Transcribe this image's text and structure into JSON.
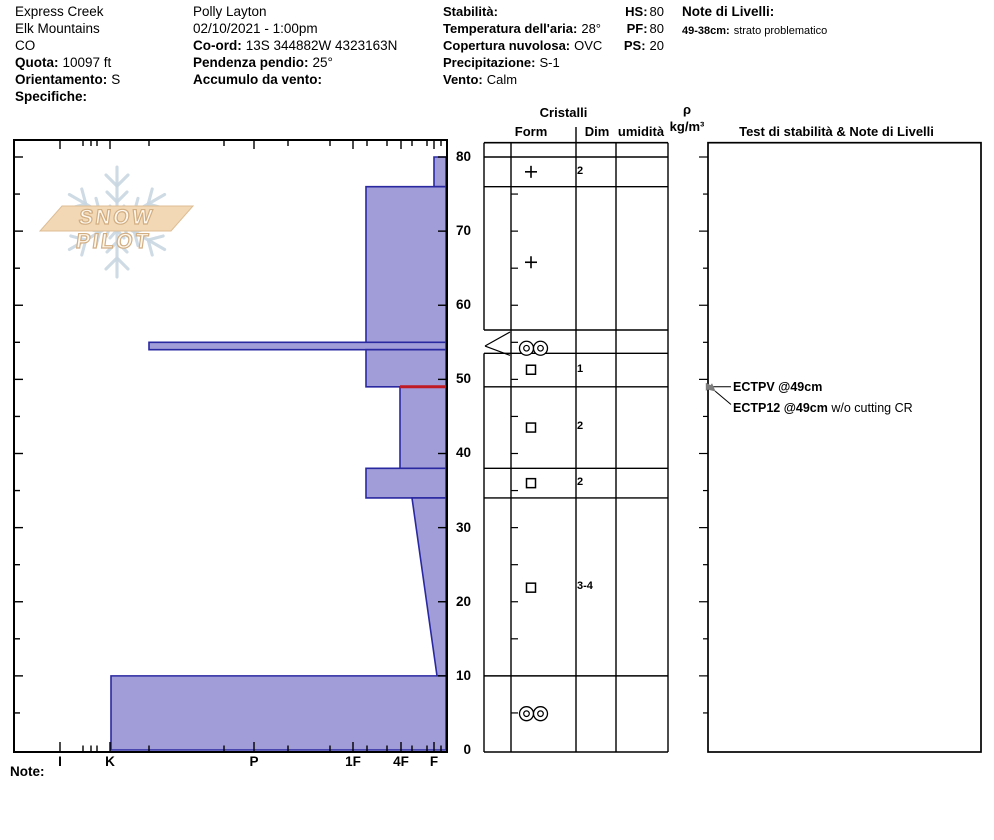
{
  "title_block": {
    "col1": {
      "site": "Express Creek",
      "range": "Elk Mountains",
      "state": "CO",
      "elev_label": "Quota:",
      "elev_value": "10097 ft",
      "aspect_label": "Orientamento:",
      "aspect_value": "S",
      "spec_label": "Specifiche:"
    },
    "col2": {
      "observer": "Polly Layton",
      "datetime": "02/10/2021 - 1:00pm",
      "coord_label": "Co-ord:",
      "coord_value": "13S 344882W 4323163N",
      "slope_label": "Pendenza pendio:",
      "slope_value": "25°",
      "windload_label": "Accumulo da vento:"
    },
    "col3": {
      "stability_label": "Stabilità:",
      "airtemp_label": "Temperatura dell'aria:",
      "airtemp_value": "28°",
      "sky_label": "Copertura nuvolosa:",
      "sky_value": "OVC",
      "precip_label": "Precipitazione:",
      "precip_value": "S-1",
      "wind_label": "Vento:",
      "wind_value": "Calm"
    },
    "totals": {
      "hs_label": "HS:",
      "hs_value": "80",
      "pf_label": "PF:",
      "pf_value": "80",
      "ps_label": "PS:",
      "ps_value": "20"
    },
    "col4": {
      "title": "Note di Livelli:",
      "note_label": "49-38cm:",
      "note_value": "strato problematico"
    }
  },
  "logo": {
    "text": "SNOW PILOT"
  },
  "columns": {
    "cristalli": "Cristalli",
    "form": "Form",
    "dim": "Dim",
    "umidita": "umidità",
    "rho": "ρ",
    "rho_units": "kg/m³",
    "tests": "Test di stabilità & Note di Livelli"
  },
  "axis": {
    "hardness_labels": [
      "I",
      "K",
      "P",
      "1F",
      "4F",
      "F"
    ],
    "depth_labels": [
      "80",
      "70",
      "60",
      "50",
      "40",
      "30",
      "20",
      "10",
      "0"
    ],
    "note_label": "Note:"
  },
  "annotations": {
    "test1": "ECTPV @49cm",
    "test2_bold": "ECTP12 @49cm",
    "test2_rest": " w/o cutting CR"
  },
  "chart_data": {
    "type": "bar",
    "title": "Hand-hardness snow profile (SnowPilot)",
    "ylabel": "height above ground (cm)",
    "ylim": [
      0,
      82.3
    ],
    "x_categories": [
      "I",
      "K",
      "P",
      "1F",
      "4F",
      "F"
    ],
    "x_categories_px": [
      60,
      110,
      254,
      353,
      401,
      434
    ],
    "minor_ticks_px": [
      83,
      91,
      97,
      149,
      224,
      288,
      330,
      367,
      387,
      412,
      427,
      441
    ],
    "legend_position": "none",
    "grid": false,
    "layers": [
      {
        "top_cm": 80,
        "bottom_cm": 76,
        "hardness": "F",
        "left_px_top": 434,
        "left_px_bottom": 434,
        "form": "+ (precip particles)",
        "size_mm": "2"
      },
      {
        "top_cm": 76,
        "bottom_cm": 55,
        "hardness": "1F",
        "left_px_top": 366,
        "left_px_bottom": 366,
        "form": "+ (precip particles)",
        "size_mm": ""
      },
      {
        "top_cm": 55,
        "bottom_cm": 54,
        "hardness": "K+",
        "left_px_top": 149,
        "left_px_bottom": 149,
        "form": "MF crust (oo)",
        "size_mm": ""
      },
      {
        "top_cm": 54,
        "bottom_cm": 49,
        "hardness": "1F",
        "left_px_top": 366,
        "left_px_bottom": 366,
        "form": "facets (square)",
        "size_mm": "1"
      },
      {
        "top_cm": 49,
        "bottom_cm": 38,
        "hardness": "4F",
        "left_px_top": 400,
        "left_px_bottom": 400,
        "form": "facets (square)",
        "size_mm": "2"
      },
      {
        "top_cm": 38,
        "bottom_cm": 34,
        "hardness": "1F",
        "left_px_top": 366,
        "left_px_bottom": 366,
        "form": "facets (square)",
        "size_mm": "2"
      },
      {
        "top_cm": 34,
        "bottom_cm": 10,
        "hardness": "4F to F",
        "left_px_top": 412,
        "left_px_bottom": 437,
        "form": "facets (square)",
        "size_mm": "3-4"
      },
      {
        "top_cm": 10,
        "bottom_cm": 0,
        "hardness": "K",
        "left_px_top": 111,
        "left_px_bottom": 111,
        "form": "MF (oo)",
        "size_mm": ""
      }
    ],
    "flagged_interface": {
      "cm": 49,
      "left_px": 400,
      "color": "#c01a24"
    },
    "tests": [
      "ECTPV @49cm",
      "ECTP12 @49cm w/o cutting CR"
    ],
    "colors": {
      "layer_fill": "#a09dd9",
      "layer_stroke": "#2a28a0",
      "frame": "#000000",
      "flake": "#c9d7e2",
      "banner_fill": "#f2d8b4",
      "banner_stroke": "#ddbd95",
      "arrow_gray": "#7d7d7d"
    },
    "table": {
      "x_lines": [
        484,
        511,
        576,
        616,
        668
      ],
      "top_px": 142.7,
      "bottom_px": 752,
      "row_lines_cm": [
        80,
        76,
        56.66,
        53.51,
        49,
        38,
        34,
        10
      ],
      "ruler_ticks_cm": [
        5,
        15,
        20,
        25,
        30,
        35,
        40,
        45,
        50,
        55,
        60,
        65,
        70,
        75
      ],
      "rho_ticks_cm": [
        5,
        10,
        15,
        20,
        25,
        30,
        35,
        40,
        45,
        50,
        55,
        60,
        65,
        70,
        75,
        80
      ],
      "callout": {
        "apex_cm": 54.5,
        "row_top_cm": 56.66,
        "row_bottom_cm": 53.51
      },
      "symbols": [
        {
          "type": "plus",
          "cm": 78.0
        },
        {
          "type": "plus",
          "cm": 65.8
        },
        {
          "type": "mf",
          "cm": 54.2
        },
        {
          "type": "square",
          "cm": 51.3
        },
        {
          "type": "square",
          "cm": 43.5
        },
        {
          "type": "square",
          "cm": 36.0
        },
        {
          "type": "square",
          "cm": 21.9
        },
        {
          "type": "mf",
          "cm": 4.9
        }
      ],
      "test_column_x": [
        708,
        981
      ]
    }
  }
}
